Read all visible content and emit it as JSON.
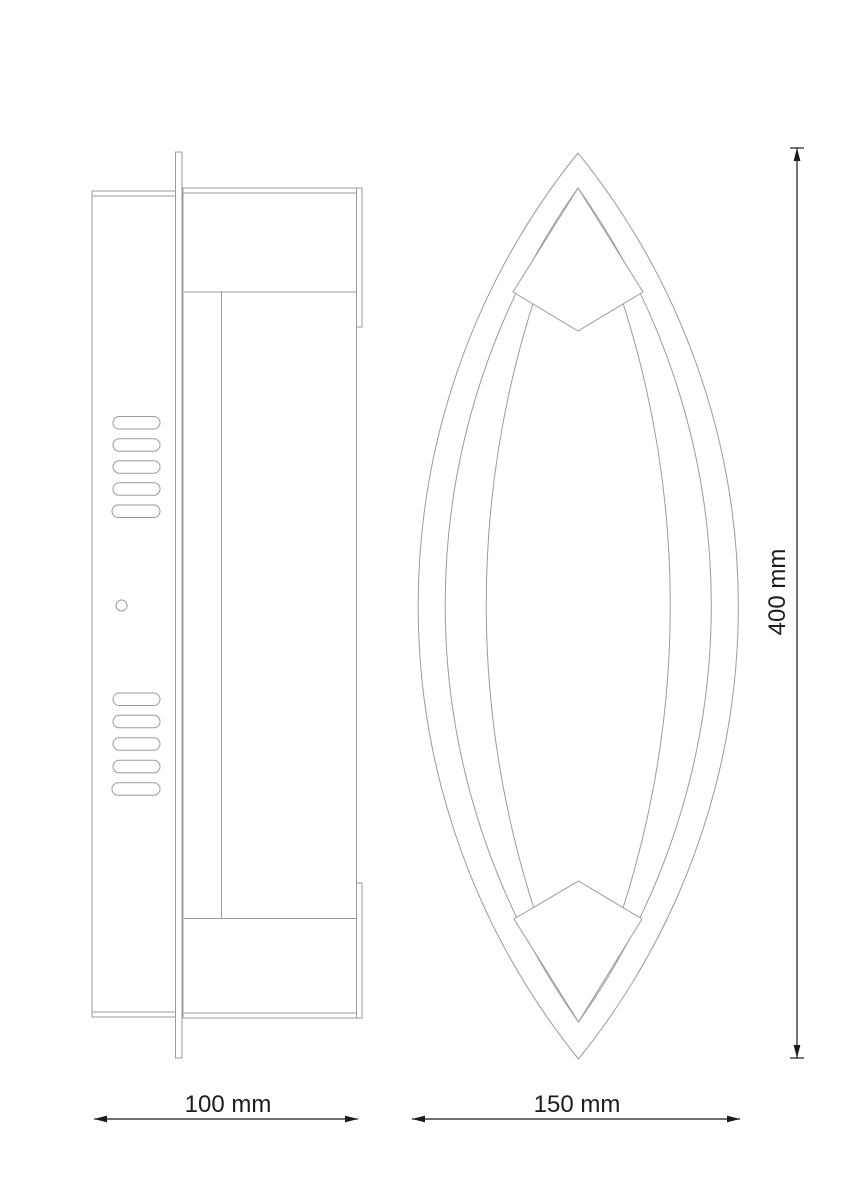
{
  "dims": {
    "side_width": "100 mm",
    "front_width": "150 mm",
    "height": "400 mm"
  },
  "colors": {
    "outline_gray": "#9b9b9b",
    "dimension_black": "#1c1c1c",
    "background": "#ffffff"
  }
}
